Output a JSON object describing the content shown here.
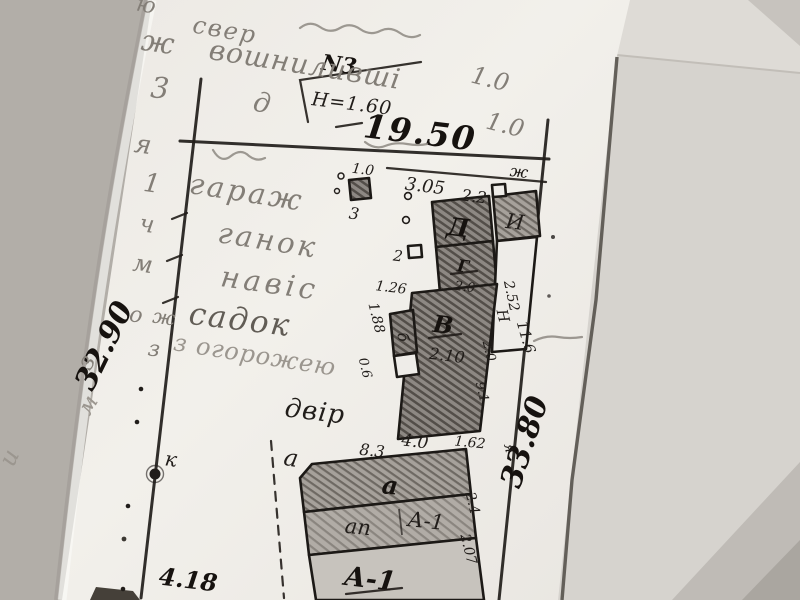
{
  "photo": {
    "background_color": "#b2aea8",
    "paper_color": "#f0eee9",
    "underlay_color": "#d6d3ce",
    "ink_color": "#211d1a",
    "pencil_color": "#837e77"
  },
  "notes_top": {
    "line1": "свер",
    "line2": "вошниливші",
    "plot_no": "N3",
    "pencil_10_a": "1.0",
    "pencil_10_b": "1.0",
    "pencil_d": "д"
  },
  "margin_letters": [
    "ж",
    "3",
    "я",
    "1",
    "ч",
    "м",
    "о",
    "з",
    "ю",
    "и",
    "м"
  ],
  "site_words": {
    "garage": "гараж",
    "porch": "ганок",
    "canopy": "навіс",
    "garden": "садок",
    "fence": "з огорожею",
    "yard": "двір",
    "marker_k": "к",
    "marker_a": "а",
    "marker_ya": "я",
    "marker_zh_plan": "ж",
    "marker_zh_pencil": "ж",
    "marker_z_left": "з",
    "marker_2": "2",
    "marker_3": "3"
  },
  "dimensions": {
    "top": "19.50",
    "height_note": "H=1.60",
    "d305": "3.05",
    "d22": "2.2",
    "d10": "1.0",
    "left_side": "32.90",
    "right_side": "33.80",
    "d126": "1.26",
    "d188": "1.88",
    "d06": "0.6",
    "d252": "2.52",
    "dH": "Н",
    "d116": "11.6",
    "d20_right": "2.0",
    "d91": "9.1",
    "d83": "8.3",
    "d40": "4.0",
    "d162": "1.62",
    "d24": "2.4",
    "d207": "2.07",
    "d418": "4.18"
  },
  "buildings": {
    "D": "Д",
    "I": "И",
    "G": "Г",
    "G_dim": "2.0",
    "V": "В",
    "V_dim": "2.10",
    "b": "б",
    "a_strip": "а",
    "ap_strip": "ап",
    "A1_strip": "А-1",
    "A1_main": "А-1"
  }
}
